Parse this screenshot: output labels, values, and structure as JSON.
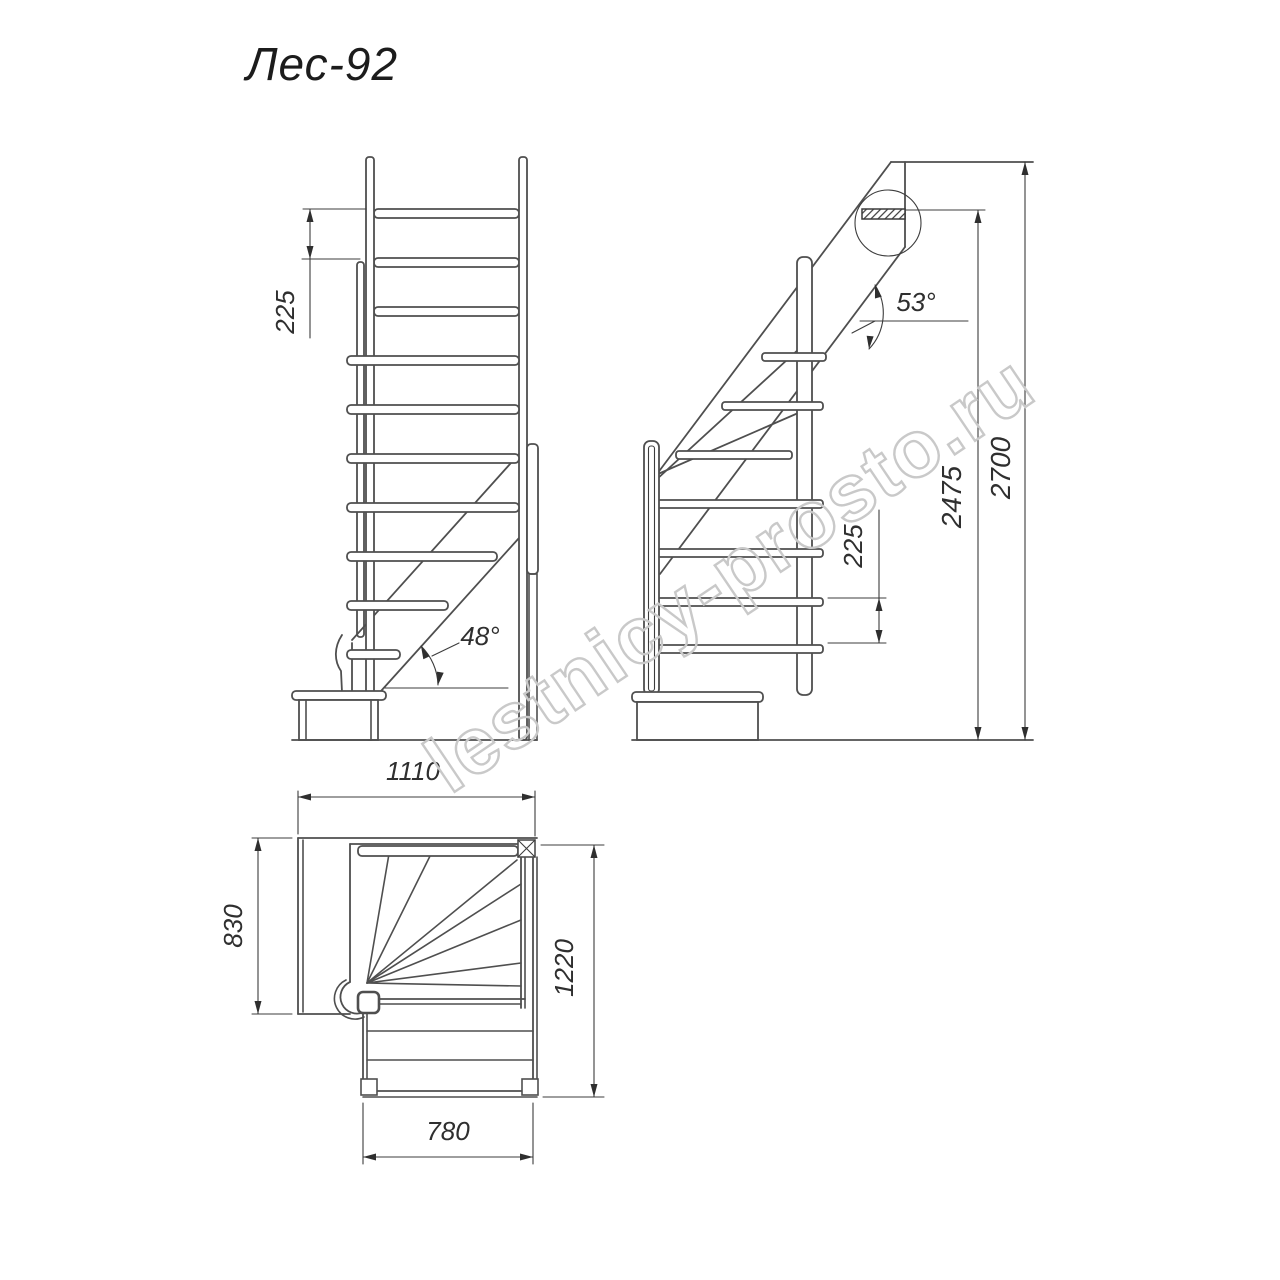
{
  "title": "Лес-92",
  "watermark": "lestnicy-prosto.ru",
  "views": {
    "front": {
      "riser_height": "225",
      "angle": "48°"
    },
    "side": {
      "riser_height": "225",
      "intermediate_height": "2475",
      "total_height": "2700",
      "angle": "53°"
    },
    "plan": {
      "top_width": "1110",
      "landing_depth": "830",
      "right_length": "1220",
      "flight_width": "780"
    }
  }
}
